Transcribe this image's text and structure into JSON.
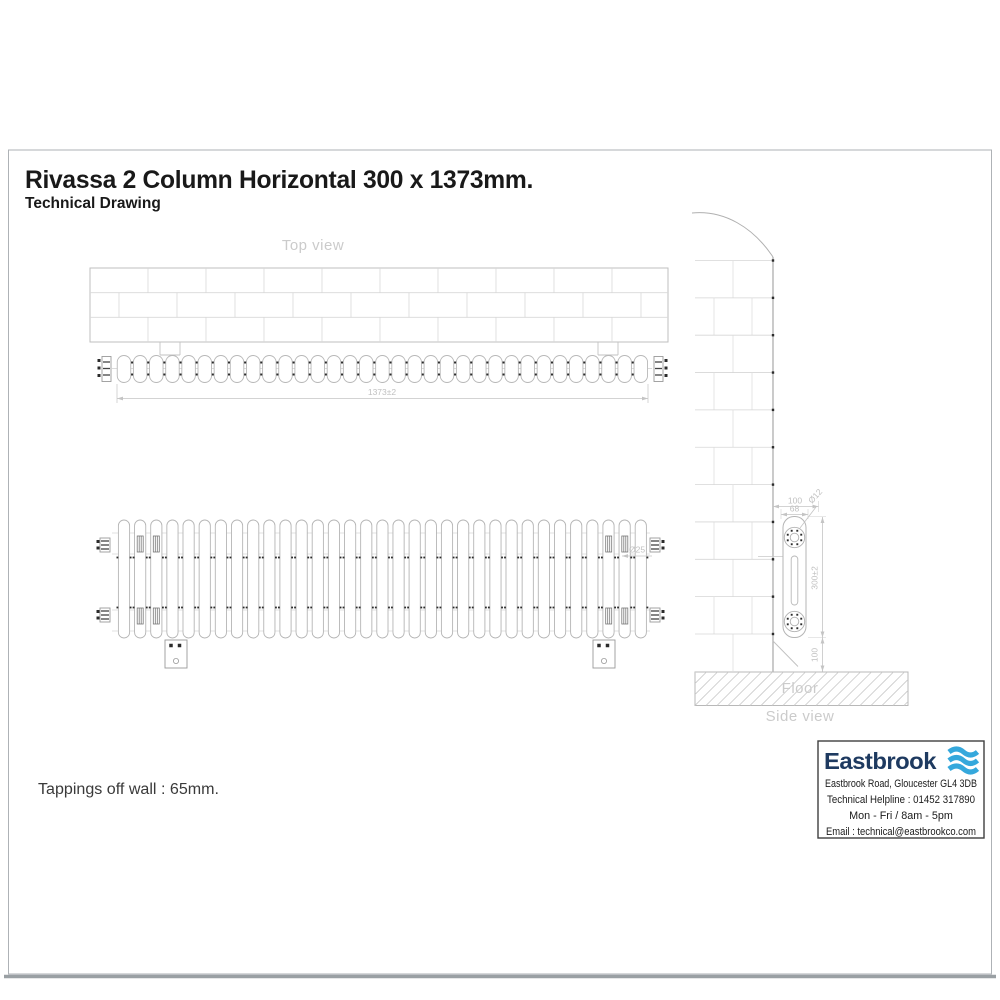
{
  "page": {
    "title": "Rivassa 2 Column Horizontal 300 x 1373mm.",
    "subtitle": "Technical Drawing",
    "tappings_note": "Tappings off wall : 65mm."
  },
  "views": {
    "top": {
      "label": "Top view",
      "dim_length": "1373±2",
      "sections": 33
    },
    "front": {
      "dim_tube": "Ø25",
      "sections": 33
    },
    "side": {
      "label": "Side view",
      "floor_label": "Floor",
      "dim_depth": "100",
      "dim_holes": "68",
      "dim_hole_dia": "Ø12",
      "dim_height": "300±2",
      "dim_clearance": "100"
    }
  },
  "brand": {
    "name": "Eastbrook",
    "address": "Eastbrook Road, Gloucester GL4 3DB",
    "helpline": "Technical Helpline : 01452 317890",
    "hours": "Mon - Fri / 8am - 5pm",
    "email": "Email : technical@eastbrookco.com",
    "navy": "#1e3a60",
    "wave": "#35a8dc"
  }
}
